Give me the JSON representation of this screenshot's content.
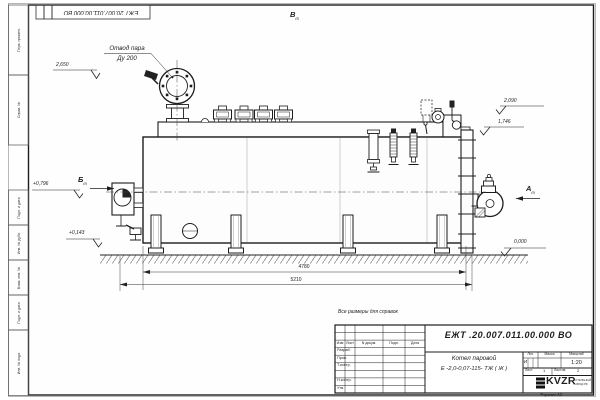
{
  "corner_stamp": {
    "doc_number": "ЕЖТ 20.007.011.00.000  ВО"
  },
  "margin": {
    "top_labels": [
      "Перв. примен.",
      "Справ. №"
    ],
    "bottom_labels": [
      "Подп. и дата",
      "Инв. № дубл.",
      "Взам. инв. №",
      "Подп. и дата",
      "Инв. № подл."
    ]
  },
  "drawing": {
    "view_top": "В",
    "view_left": "Б",
    "view_right": "А",
    "view_ref": "(2)",
    "steam_label_line1": "Отвод пара",
    "steam_label_line2": "Ду 200",
    "elev_2650": "2,650",
    "elev_2090": "2,090",
    "elev_1746": "1,746",
    "elev_0796": "+0,796",
    "elev_0143": "+0,143",
    "elev_0000": "0,000",
    "dim_inner": "4780",
    "dim_overall": "5210"
  },
  "title_block": {
    "note": "Все размеры для справок",
    "doc_number": "ЕЖТ .20.007.011.00.000  ВО",
    "col_headers": [
      "Изм",
      "Лист",
      "N докум.",
      "Подп.",
      "Дата"
    ],
    "row_labels": [
      "Разраб.",
      "Пров.",
      "Т.контр.",
      "",
      "Н.контр.",
      "Утв."
    ],
    "product_line1": "Котел паровой",
    "product_line2": "Е -2,0-0,07-115- ТЖ ( Ж )",
    "lit_header": "Лит.",
    "mass_header": "Масса",
    "scale_header": "Масштаб",
    "lit_value": "И",
    "scale_value": "1:20",
    "sheet_label": "Лист",
    "sheet_value": "1",
    "sheets_label": "Листов",
    "sheets_value": "2",
    "logo_text": "KVZR",
    "logo_caption1": "КОТЕЛЬНЫЙ",
    "logo_caption2": "ЗАВОД РФ",
    "format_label": "Формат А3"
  }
}
